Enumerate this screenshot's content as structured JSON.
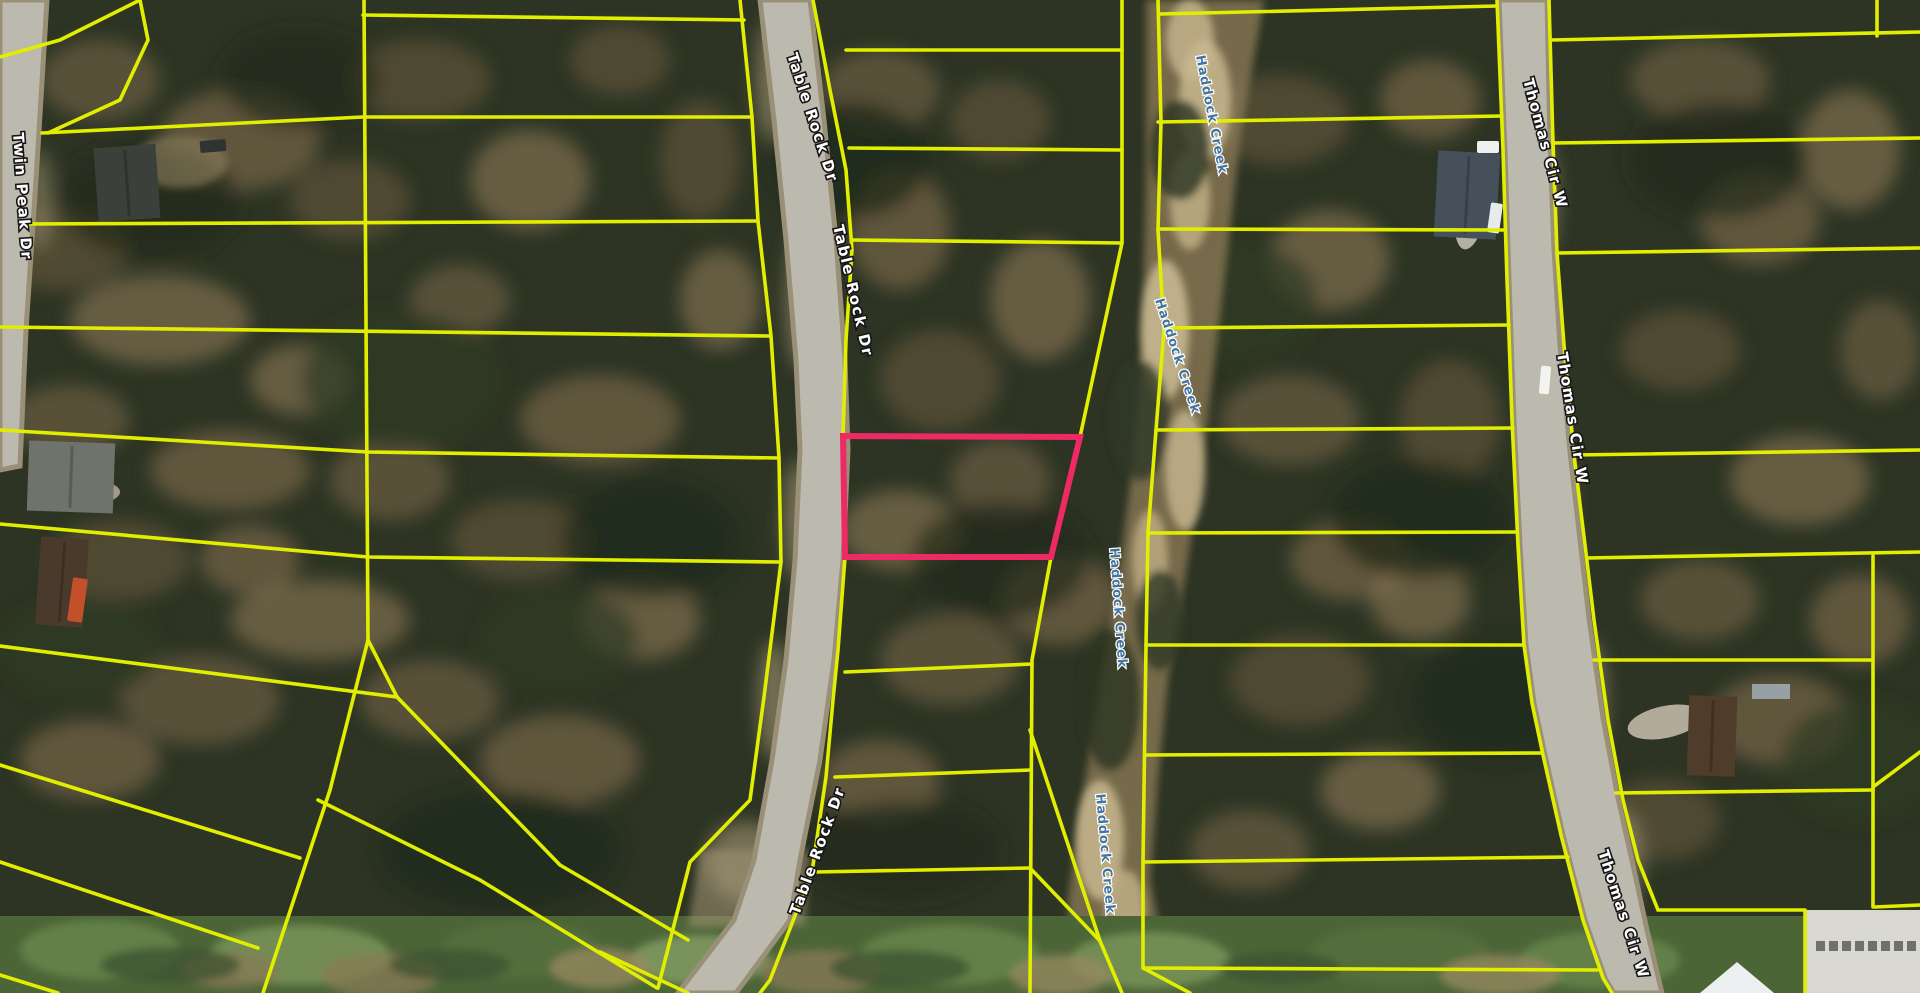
{
  "app": {
    "type": "satellite-parcel-map-view"
  },
  "map_data": {
    "canvas": {
      "width": 1920,
      "height": 993
    },
    "colors": {
      "parcel_line": "#e2ee00",
      "highlight": "#ee2a64",
      "road_fill": "#bcb9ae",
      "road_edge": "#9a9078",
      "road_label_fill": "#ffffff",
      "road_label_outline": "#161616",
      "creek_label_fill": "#44749e",
      "bg_base": "#2d3423",
      "seam_green": "#4c6537"
    },
    "labels": [
      {
        "text": "Table Rock Dr",
        "x": 787,
        "y": 55,
        "rot": 72,
        "kind": "road"
      },
      {
        "text": "Table Rock Dr",
        "x": 833,
        "y": 226,
        "rot": 77,
        "kind": "road"
      },
      {
        "text": "Table Rock Dr",
        "x": 799,
        "y": 916,
        "rot": -70,
        "kind": "road"
      },
      {
        "text": "Twin Peak Dr",
        "x": 13,
        "y": 133,
        "rot": 86,
        "kind": "road"
      },
      {
        "text": "Thomas Cir W",
        "x": 1523,
        "y": 80,
        "rot": 75,
        "kind": "road"
      },
      {
        "text": "Thomas Cir W",
        "x": 1557,
        "y": 353,
        "rot": 81,
        "kind": "road"
      },
      {
        "text": "Thomas Cir W",
        "x": 1598,
        "y": 852,
        "rot": 72,
        "kind": "road"
      },
      {
        "text": "Haddock Creek",
        "x": 1196,
        "y": 56,
        "rot": 79,
        "kind": "water"
      },
      {
        "text": "Haddock Creek",
        "x": 1155,
        "y": 300,
        "rot": 72,
        "kind": "water"
      },
      {
        "text": "Haddock Creek",
        "x": 1110,
        "y": 548,
        "rot": 86,
        "kind": "water"
      },
      {
        "text": "Haddock Creek",
        "x": 1096,
        "y": 794,
        "rot": 85,
        "kind": "water"
      }
    ],
    "highlight_parcel": {
      "points": [
        [
          843,
          436
        ],
        [
          1080,
          437
        ],
        [
          1051,
          557
        ],
        [
          845,
          557
        ]
      ],
      "color": "#ee2a64"
    },
    "parcel_lines": [
      [
        [
          0,
          57
        ],
        [
          60,
          40
        ],
        [
          140,
          0
        ]
      ],
      [
        [
          140,
          0
        ],
        [
          148,
          40
        ],
        [
          120,
          100
        ],
        [
          48,
          133
        ]
      ],
      [
        [
          42,
          133
        ],
        [
          363,
          117
        ],
        [
          752,
          117
        ]
      ],
      [
        [
          20,
          224
        ],
        [
          757,
          221
        ]
      ],
      [
        [
          363,
          15
        ],
        [
          744,
          20
        ]
      ],
      [
        [
          0,
          327
        ],
        [
          770,
          336
        ]
      ],
      [
        [
          0,
          430
        ],
        [
          368,
          452
        ],
        [
          779,
          458
        ]
      ],
      [
        [
          0,
          524
        ],
        [
          368,
          557
        ],
        [
          781,
          562
        ]
      ],
      [
        [
          0,
          646
        ],
        [
          397,
          697
        ]
      ],
      [
        [
          364,
          0
        ],
        [
          368,
          640
        ],
        [
          397,
          697
        ]
      ],
      [
        [
          740,
          0
        ],
        [
          752,
          117
        ],
        [
          758,
          221
        ],
        [
          771,
          336
        ],
        [
          779,
          458
        ],
        [
          781,
          562
        ],
        [
          764,
          697
        ],
        [
          750,
          800
        ],
        [
          690,
          862
        ],
        [
          658,
          988
        ]
      ],
      [
        [
          813,
          0
        ],
        [
          830,
          90
        ],
        [
          846,
          170
        ],
        [
          852,
          250
        ],
        [
          846,
          340
        ],
        [
          843,
          437
        ]
      ],
      [
        [
          845,
          557
        ],
        [
          838,
          650
        ],
        [
          833,
          700
        ],
        [
          826,
          777
        ],
        [
          812,
          872
        ],
        [
          770,
          980
        ],
        [
          760,
          993
        ]
      ],
      [
        [
          1122,
          0
        ],
        [
          1122,
          243
        ],
        [
          1080,
          437
        ]
      ],
      [
        [
          1051,
          557
        ],
        [
          1032,
          660
        ],
        [
          1030,
          993
        ]
      ],
      [
        [
          1030,
          730
        ],
        [
          1100,
          941
        ]
      ],
      [
        [
          1030,
          868
        ],
        [
          1100,
          941
        ]
      ],
      [
        [
          1100,
          941
        ],
        [
          1122,
          993
        ]
      ],
      [
        [
          846,
          50
        ],
        [
          1122,
          50
        ]
      ],
      [
        [
          849,
          148
        ],
        [
          1122,
          150
        ]
      ],
      [
        [
          852,
          240
        ],
        [
          1122,
          243
        ]
      ],
      [
        [
          845,
          672
        ],
        [
          1032,
          664
        ]
      ],
      [
        [
          835,
          777
        ],
        [
          1031,
          770
        ]
      ],
      [
        [
          815,
          872
        ],
        [
          1030,
          868
        ]
      ],
      [
        [
          1158,
          0
        ],
        [
          1161,
          123
        ],
        [
          1158,
          230
        ],
        [
          1164,
          330
        ],
        [
          1156,
          430
        ],
        [
          1148,
          533
        ],
        [
          1146,
          645
        ],
        [
          1143,
          862
        ],
        [
          1143,
          968
        ],
        [
          1190,
          993
        ]
      ],
      [
        [
          1160,
          14
        ],
        [
          1497,
          6
        ]
      ],
      [
        [
          1158,
          122
        ],
        [
          1502,
          116
        ]
      ],
      [
        [
          1158,
          229
        ],
        [
          1505,
          230
        ]
      ],
      [
        [
          1164,
          328
        ],
        [
          1509,
          325
        ]
      ],
      [
        [
          1156,
          430
        ],
        [
          1513,
          428
        ]
      ],
      [
        [
          1148,
          533
        ],
        [
          1517,
          532
        ]
      ],
      [
        [
          1146,
          645
        ],
        [
          1523,
          645
        ]
      ],
      [
        [
          1145,
          755
        ],
        [
          1542,
          753
        ]
      ],
      [
        [
          1143,
          862
        ],
        [
          1568,
          857
        ]
      ],
      [
        [
          1143,
          968
        ],
        [
          1597,
          970
        ]
      ],
      [
        [
          1497,
          0
        ],
        [
          1503,
          150
        ],
        [
          1507,
          280
        ],
        [
          1512,
          420
        ],
        [
          1518,
          545
        ],
        [
          1524,
          645
        ],
        [
          1532,
          703
        ],
        [
          1543,
          755
        ],
        [
          1561,
          835
        ],
        [
          1583,
          920
        ],
        [
          1603,
          978
        ],
        [
          1612,
          993
        ]
      ],
      [
        [
          1549,
          0
        ],
        [
          1553,
          143
        ],
        [
          1557,
          253
        ],
        [
          1564,
          345
        ],
        [
          1574,
          455
        ],
        [
          1585,
          545
        ],
        [
          1594,
          620
        ],
        [
          1608,
          720
        ],
        [
          1623,
          800
        ],
        [
          1638,
          860
        ],
        [
          1658,
          910
        ]
      ],
      [
        [
          1658,
          910
        ],
        [
          1805,
          910
        ],
        [
          1805,
          993
        ]
      ],
      [
        [
          1551,
          40
        ],
        [
          1920,
          32
        ]
      ],
      [
        [
          1553,
          143
        ],
        [
          1920,
          138
        ]
      ],
      [
        [
          1557,
          253
        ],
        [
          1920,
          248
        ]
      ],
      [
        [
          1574,
          455
        ],
        [
          1920,
          450
        ]
      ],
      [
        [
          1587,
          558
        ],
        [
          1920,
          552
        ]
      ],
      [
        [
          1594,
          660
        ],
        [
          1873,
          660
        ]
      ],
      [
        [
          1616,
          793
        ],
        [
          1873,
          790
        ]
      ],
      [
        [
          1873,
          556
        ],
        [
          1873,
          907
        ]
      ],
      [
        [
          1873,
          787
        ],
        [
          1920,
          752
        ]
      ],
      [
        [
          1875,
          907
        ],
        [
          1920,
          905
        ]
      ],
      [
        [
          1877,
          0
        ],
        [
          1877,
          36
        ]
      ],
      [
        [
          0,
          765
        ],
        [
          300,
          858
        ]
      ],
      [
        [
          0,
          862
        ],
        [
          258,
          948
        ]
      ],
      [
        [
          368,
          640
        ],
        [
          330,
          790
        ],
        [
          263,
          993
        ]
      ],
      [
        [
          318,
          800
        ],
        [
          480,
          880
        ],
        [
          657,
          988
        ]
      ],
      [
        [
          397,
          697
        ],
        [
          560,
          865
        ],
        [
          688,
          940
        ]
      ],
      [
        [
          0,
          975
        ],
        [
          58,
          993
        ]
      ],
      [
        [
          600,
          952
        ],
        [
          688,
          993
        ]
      ]
    ],
    "structures": [
      {
        "kind": "roof",
        "x": 96,
        "y": 146,
        "w": 62,
        "h": 74,
        "rot": -4,
        "color": "#3b403a"
      },
      {
        "kind": "roof",
        "x": 28,
        "y": 442,
        "w": 86,
        "h": 70,
        "rot": 2,
        "color": "#70726c"
      },
      {
        "kind": "roof",
        "x": 38,
        "y": 538,
        "w": 48,
        "h": 88,
        "rot": 4,
        "color": "#4a3a2c"
      },
      {
        "kind": "roof",
        "x": 1436,
        "y": 152,
        "w": 62,
        "h": 86,
        "rot": 3,
        "color": "#45505a"
      },
      {
        "kind": "roof",
        "x": 1688,
        "y": 696,
        "w": 48,
        "h": 80,
        "rot": 2,
        "color": "#503c2b"
      },
      {
        "kind": "roof",
        "x": 1752,
        "y": 684,
        "w": 38,
        "h": 15,
        "rot": 0,
        "color": "#97a0a4"
      },
      {
        "kind": "building",
        "x": 1806,
        "y": 910,
        "w": 114,
        "h": 83,
        "rot": 0,
        "color": "#d8d8d1"
      },
      {
        "kind": "tent",
        "points": [
          [
            1700,
            993
          ],
          [
            1737,
            962
          ],
          [
            1774,
            993
          ]
        ],
        "color": "#eceff0"
      }
    ],
    "vehicles": [
      {
        "x": 1540,
        "y": 366,
        "w": 10,
        "h": 28,
        "rot": 5,
        "color": "#f3f4f0"
      },
      {
        "x": 1477,
        "y": 141,
        "w": 22,
        "h": 12,
        "rot": 0,
        "color": "#eef0f1"
      },
      {
        "x": 1489,
        "y": 203,
        "w": 12,
        "h": 30,
        "rot": 8,
        "color": "#e8ebec"
      },
      {
        "x": 70,
        "y": 578,
        "w": 15,
        "h": 44,
        "rot": 8,
        "color": "#c2502b"
      },
      {
        "x": 200,
        "y": 140,
        "w": 26,
        "h": 12,
        "rot": -5,
        "color": "#2f3433"
      }
    ]
  }
}
